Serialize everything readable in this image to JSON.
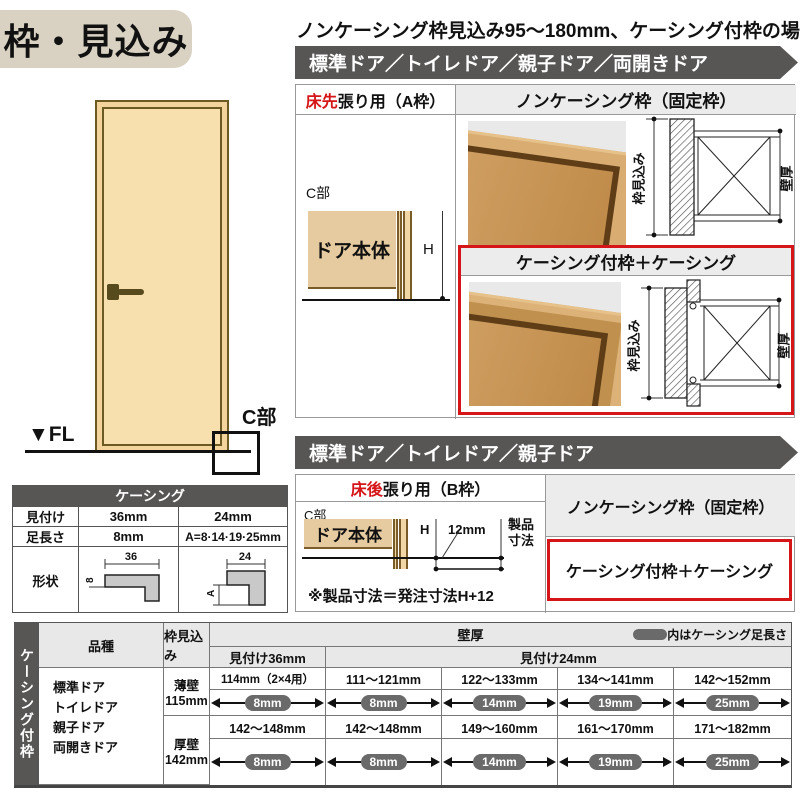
{
  "colors": {
    "accent_red": "#d61518",
    "banner_gray": "#585655",
    "panel_gray": "#ececec",
    "title_beige": "#d9d2c3",
    "door_cream": "#f8dfae",
    "wood": "#c89356",
    "pill_gray": "#6a6a6a"
  },
  "title": "枠・見込み",
  "headline": "ノンケーシング枠見込み95～180mm、ケーシング付枠の場合",
  "banner_top": "標準ドア／トイレドア／親子ドア／両開きドア",
  "banner_mid": "標準ドア／トイレドア／親子ドア",
  "door_figure": {
    "fl": "▼FL",
    "c_part": "C部"
  },
  "section_a": {
    "frame_type_red": "床先",
    "frame_type_rest": "張り用（A枠）",
    "c_part": "C部",
    "door_body": "ドア本体",
    "h": "H",
    "noncasing_title": "ノンケーシング枠（固定枠）",
    "casing_title": "ケーシング付枠＋ケーシング",
    "dim_frame_depth": "枠見込み",
    "dim_wall": "壁厚"
  },
  "section_b": {
    "frame_type_red": "床後",
    "frame_type_rest": "張り用（B枠）",
    "c_part": "C部",
    "door_body": "ドア本体",
    "h": "H",
    "offset": "12mm",
    "product_dim": "製品寸法",
    "note": "※製品寸法＝発注寸法H+12",
    "noncasing_label": "ノンケーシング枠（固定枠）",
    "casing_label": "ケーシング付枠＋ケーシング"
  },
  "casing_spec": {
    "title": "ケーシング",
    "row_face": {
      "label": "見付け",
      "v36": "36mm",
      "v24": "24mm"
    },
    "row_leg": {
      "label": "足長さ",
      "v36": "8mm",
      "v24": "A=8·14·19·25mm"
    },
    "row_shape": {
      "label": "形状",
      "dim36": "36",
      "dim36_leg": "8",
      "dim24": "24",
      "dim24_leg": "A"
    }
  },
  "main_table": {
    "side_label": "ケーシング付枠",
    "col_type": "品種",
    "col_depth": "枠見込み",
    "col_wall": "壁厚",
    "legend": "内はケーシング足長さ",
    "sub_face36": "見付け36mm",
    "sub_face24": "見付け24mm",
    "types": [
      "標準ドア",
      "トイレドア",
      "親子ドア",
      "両開きドア"
    ],
    "rows": [
      {
        "wall_kind": "薄壁",
        "depth": "115mm",
        "cells": [
          {
            "range": "114mm（2×4用）",
            "leg": "8mm"
          },
          {
            "range": "111～121mm",
            "leg": "8mm"
          },
          {
            "range": "122～133mm",
            "leg": "14mm"
          },
          {
            "range": "134～141mm",
            "leg": "19mm"
          },
          {
            "range": "142～152mm",
            "leg": "25mm"
          }
        ]
      },
      {
        "wall_kind": "厚壁",
        "depth": "142mm",
        "cells": [
          {
            "range": "142～148mm",
            "leg": "8mm"
          },
          {
            "range": "142～148mm",
            "leg": "8mm"
          },
          {
            "range": "149～160mm",
            "leg": "14mm"
          },
          {
            "range": "161～170mm",
            "leg": "19mm"
          },
          {
            "range": "171～182mm",
            "leg": "25mm"
          }
        ]
      }
    ]
  }
}
